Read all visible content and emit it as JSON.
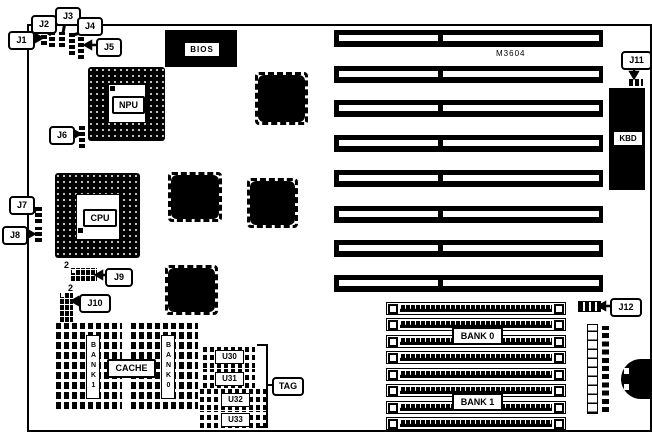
{
  "diagram": {
    "board_model": "M3604",
    "callouts": {
      "j1": "J1",
      "j2": "J2",
      "j3": "J3",
      "j4": "J4",
      "j5": "J5",
      "j6": "J6",
      "j7": "J7",
      "j8": "J8",
      "j9": "J9",
      "j10": "J10",
      "j11": "J11",
      "j12": "J12",
      "tag": "TAG"
    },
    "chips": {
      "bios": "BIOS",
      "npu": "NPU",
      "cpu": "CPU",
      "kbd": "KBD",
      "cache": "CACHE",
      "u30": "U30",
      "u31": "U31",
      "u32": "U32",
      "u33": "U33"
    },
    "cache_banks": {
      "bank1": "BANK1",
      "bank0": "BANK0"
    },
    "memory_banks": {
      "bank0": "BANK 0",
      "bank1": "BANK 1"
    },
    "pin_markers": {
      "j9": "2",
      "j10": "2"
    },
    "counts": {
      "isa_slots": 8,
      "simm_sockets": 8
    },
    "colors": {
      "ink": "#000000",
      "background": "#ffffff"
    }
  }
}
